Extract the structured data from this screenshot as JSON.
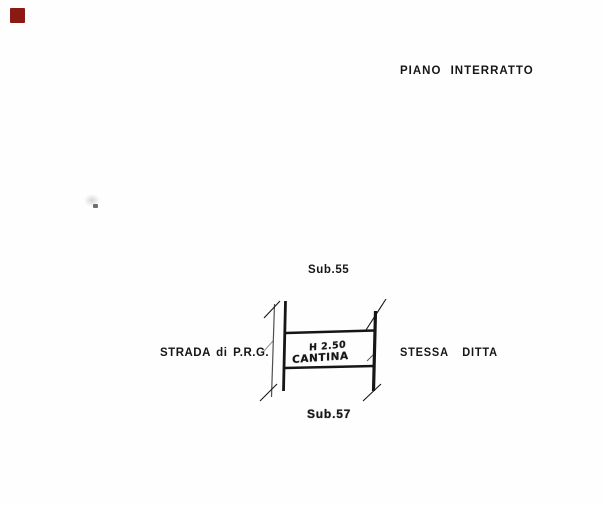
{
  "page": {
    "background": "#fefefe",
    "ink": "#161616"
  },
  "stamp": {
    "color": "#8a1a12"
  },
  "header": {
    "floor_label": "PIANO INTERRATTO"
  },
  "plan": {
    "sub_top": "Sub.55",
    "sub_bottom": "Sub.57",
    "left_label": "STRADA di P.R.G.",
    "right_label": "STESSA DITTA",
    "room": {
      "height_note": "H 2.50",
      "name": "CANTINA"
    }
  }
}
